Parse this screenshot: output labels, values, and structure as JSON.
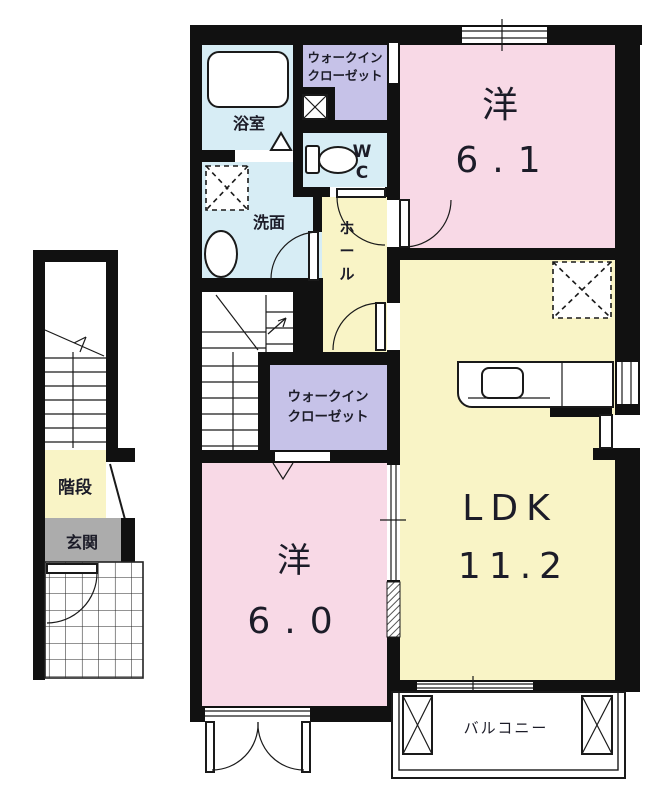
{
  "colors": {
    "room_pink": "#f8d9e6",
    "room_yellow": "#f9f4c6",
    "room_purple": "#c6c2e8",
    "room_blue": "#d7edf5",
    "entrance_gray": "#acacac",
    "wall_black": "#111111"
  },
  "unit": {
    "bedroom_top": {
      "name": "洋",
      "size": "6.1"
    },
    "bedroom_bottom": {
      "name": "洋",
      "size": "6.0"
    },
    "ldk": {
      "name": "LDK",
      "size": "11.2"
    },
    "bath": {
      "label": "浴室"
    },
    "washroom": {
      "label": "洗面"
    },
    "toilet": {
      "label": "WC"
    },
    "hall": {
      "label": "ホール"
    },
    "walkin_closet_top": {
      "line1": "ウォークイン",
      "line2": "クローゼット"
    },
    "walkin_closet_middle": {
      "line1": "ウォークイン",
      "line2": "クローゼット"
    },
    "balcony": {
      "label": "バルコニー"
    }
  },
  "stair_block": {
    "stairs": {
      "label": "階段"
    },
    "entrance": {
      "label": "玄関"
    }
  }
}
